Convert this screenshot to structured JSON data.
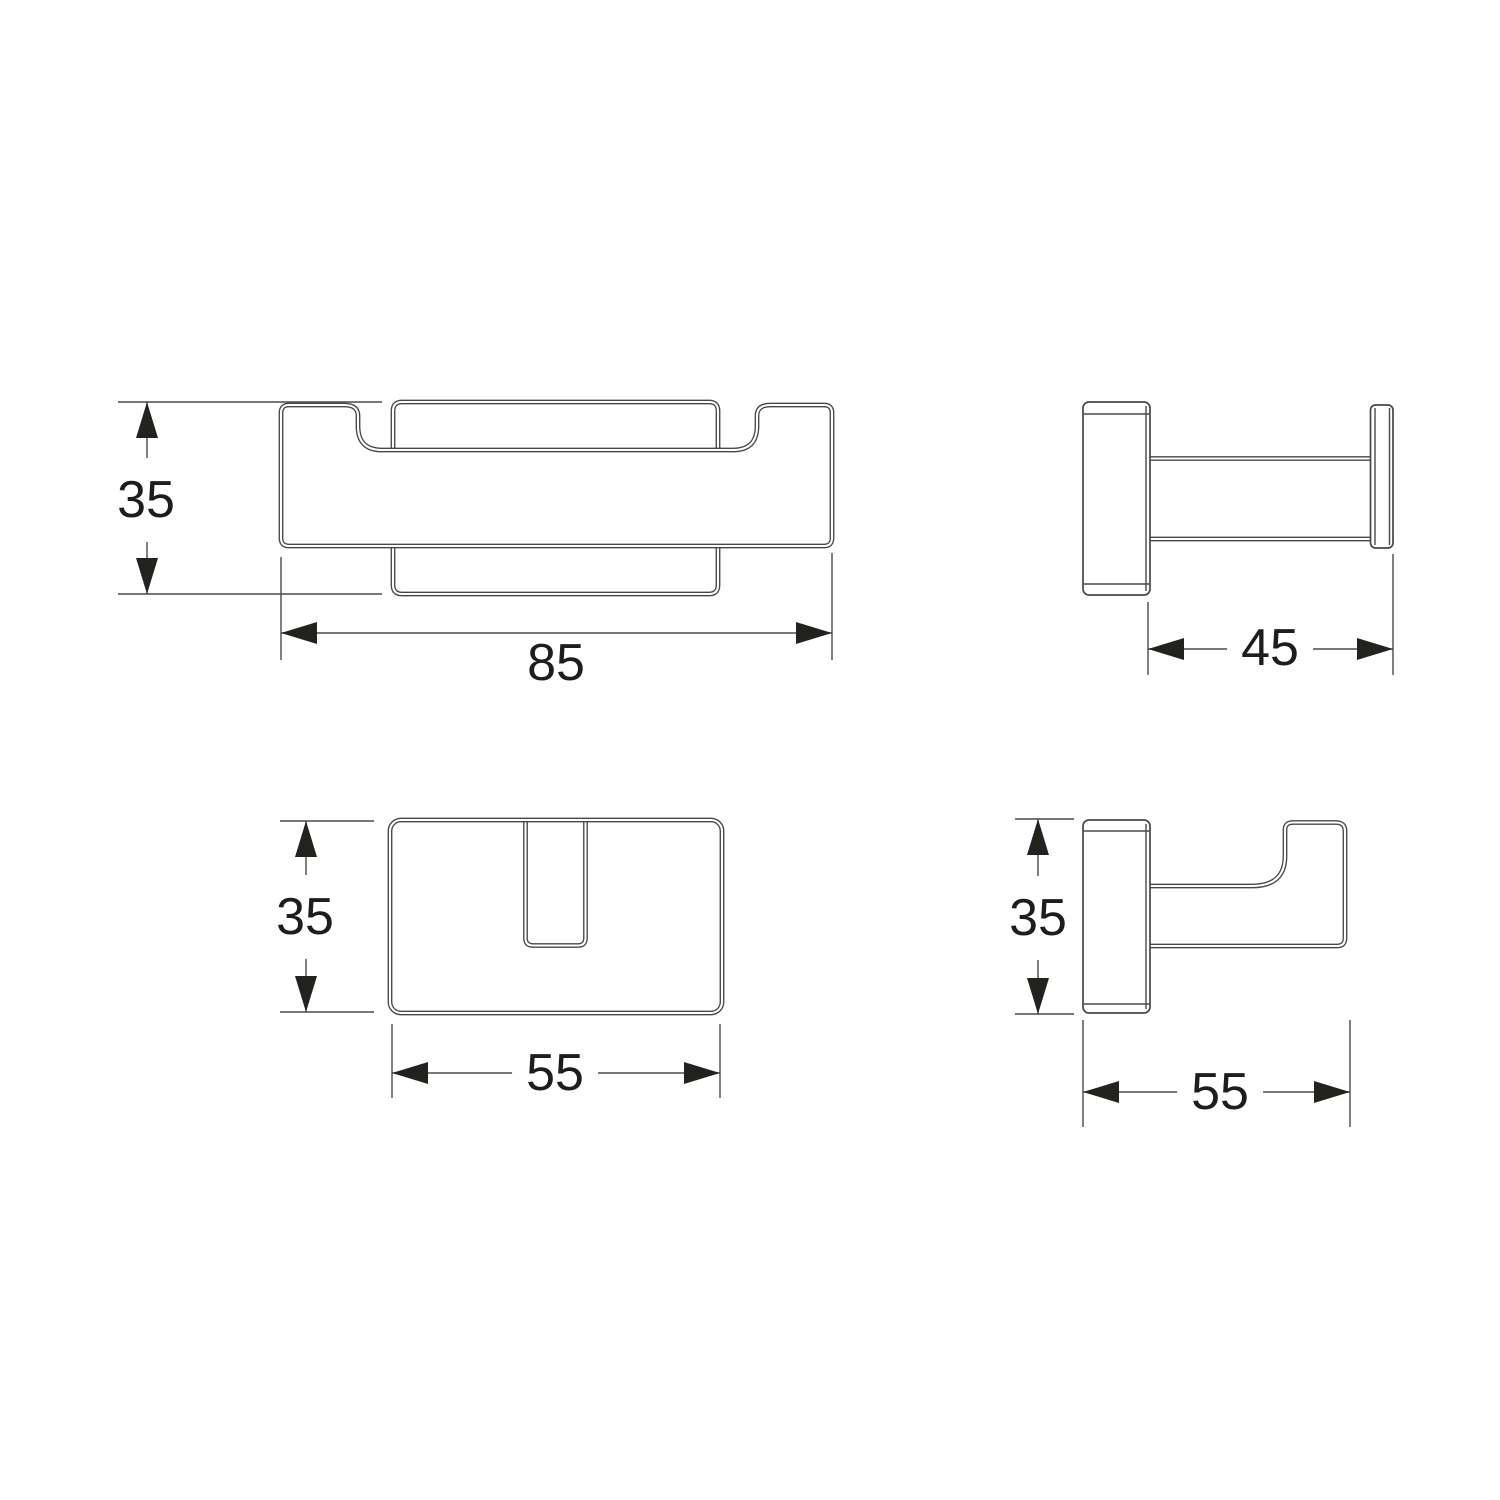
{
  "drawing": {
    "colors": {
      "background": "#ffffff",
      "outline": "#474747",
      "dimension_line": "#4a4a4a",
      "text": "#1d1d1b"
    },
    "views": {
      "front_view": {
        "height_mm": "35",
        "width_mm": "85"
      },
      "side_view": {
        "depth_mm": "45"
      },
      "top_view": {
        "height_mm": "35",
        "width_mm": "55"
      },
      "profile_view": {
        "height_mm": "35",
        "width_mm": "55"
      }
    }
  }
}
